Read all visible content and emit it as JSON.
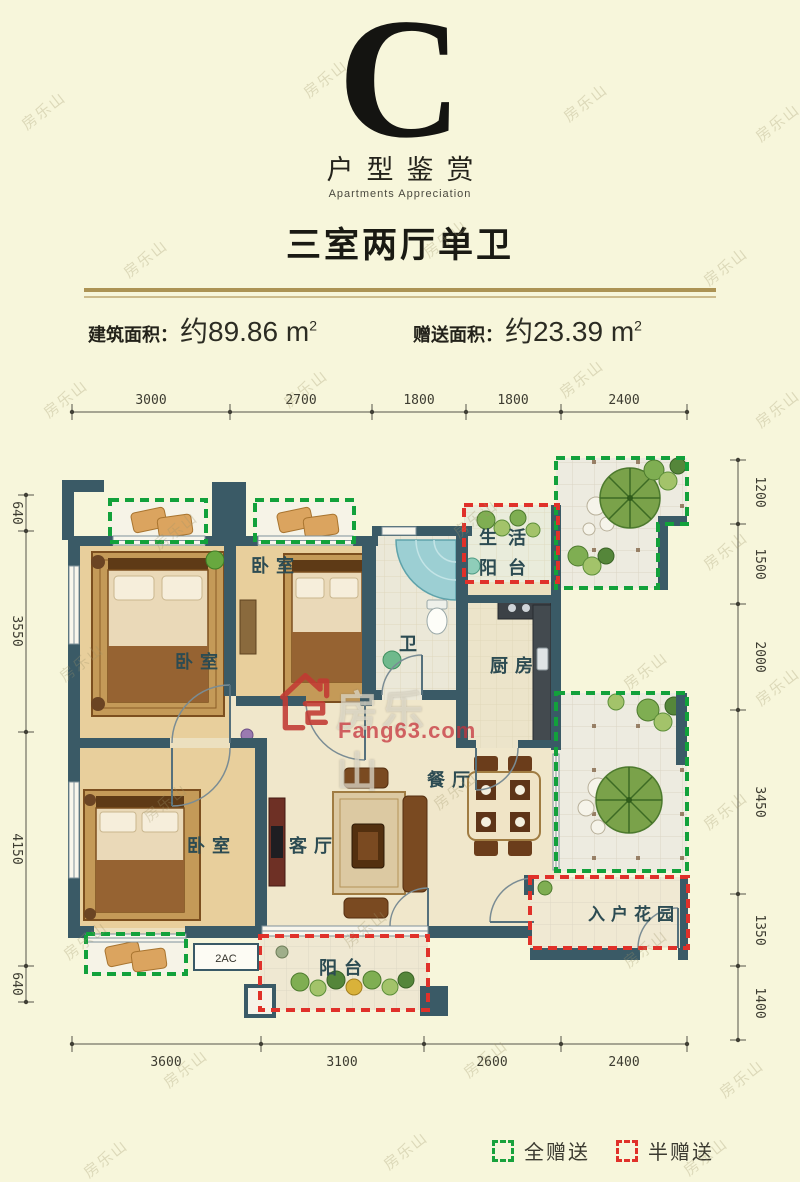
{
  "watermark": {
    "text": "房乐山",
    "logo_name": "房乐山",
    "logo_domain": "Fang63.com"
  },
  "header": {
    "letter": "C",
    "subtitle_cn": "户型鉴赏",
    "subtitle_en": "Apartments Appreciation",
    "title": "三室两厅单卫",
    "built_area_label": "建筑面积：",
    "built_area_value": "约89.86 m",
    "built_area_sup": "2",
    "gift_area_label": "赠送面积：",
    "gift_area_value": "约23.39 m",
    "gift_area_sup": "2"
  },
  "plan": {
    "rooms": {
      "bedroom_top": "卧室",
      "bedroom_left": "卧室",
      "bedroom_bottom": "卧室",
      "bath": "卫",
      "kitchen": "厨房",
      "dining": "餐厅",
      "living": "客厅",
      "balcony": "阳台",
      "service_line1": "生活",
      "service_line2": "阳台",
      "entry_garden": "入户花园",
      "ac": "2AC"
    },
    "dims_top": [
      "3000",
      "2700",
      "1800",
      "1800",
      "2400"
    ],
    "dims_bottom": [
      "3600",
      "3100",
      "2600",
      "2400"
    ],
    "dims_left": [
      "640",
      "3550",
      "4150",
      "640"
    ],
    "dims_right": [
      "1200",
      "1500",
      "2000",
      "3450",
      "1350",
      "1400"
    ],
    "colors": {
      "wall": "#3a5a66",
      "full_gift_green": "#12a13b",
      "half_gift_red": "#e0312a",
      "gold_line": "#ac9354",
      "background": "#f7f6db"
    }
  },
  "legend": {
    "full_gift": "全赠送",
    "half_gift": "半赠送"
  }
}
